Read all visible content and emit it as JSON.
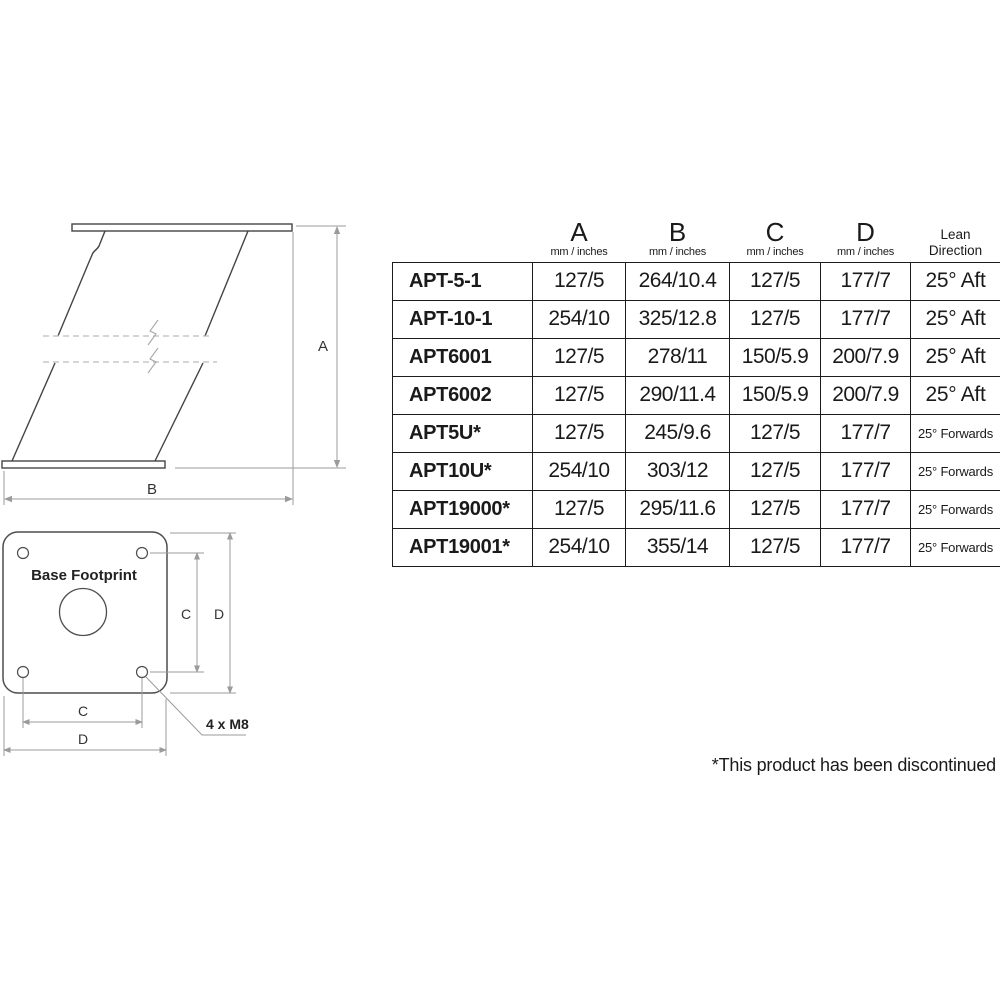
{
  "side_view": {
    "dim_a": "A",
    "dim_b": "B"
  },
  "footprint": {
    "title": "Base Footprint",
    "dim_c_vertical": "C",
    "dim_d_vertical": "D",
    "dim_c_horizontal": "C",
    "dim_d_horizontal": "D",
    "bolt_note": "4 x M8"
  },
  "spec_table": {
    "header": {
      "a": {
        "label": "A",
        "unit": "mm / inches"
      },
      "b": {
        "label": "B",
        "unit": "mm / inches"
      },
      "c": {
        "label": "C",
        "unit": "mm / inches"
      },
      "d": {
        "label": "D",
        "unit": "mm / inches"
      },
      "lean": {
        "line1": "Lean",
        "line2": "Direction"
      }
    },
    "rows": [
      {
        "model": "APT-5-1",
        "a": "127/5",
        "b": "264/10.4",
        "c": "127/5",
        "d": "177/7",
        "lean": "25° Aft"
      },
      {
        "model": "APT-10-1",
        "a": "254/10",
        "b": "325/12.8",
        "c": "127/5",
        "d": "177/7",
        "lean": "25° Aft"
      },
      {
        "model": "APT6001",
        "a": "127/5",
        "b": "278/11",
        "c": "150/5.9",
        "d": "200/7.9",
        "lean": "25° Aft"
      },
      {
        "model": "APT6002",
        "a": "127/5",
        "b": "290/11.4",
        "c": "150/5.9",
        "d": "200/7.9",
        "lean": "25° Aft"
      },
      {
        "model": "APT5U*",
        "a": "127/5",
        "b": "245/9.6",
        "c": "127/5",
        "d": "177/7",
        "lean": "25° Forwards"
      },
      {
        "model": "APT10U*",
        "a": "254/10",
        "b": "303/12",
        "c": "127/5",
        "d": "177/7",
        "lean": "25° Forwards"
      },
      {
        "model": "APT19000*",
        "a": "127/5",
        "b": "295/11.6",
        "c": "127/5",
        "d": "177/7",
        "lean": "25° Forwards"
      },
      {
        "model": "APT19001*",
        "a": "254/10",
        "b": "355/14",
        "c": "127/5",
        "d": "177/7",
        "lean": "25° Forwards"
      }
    ]
  },
  "footnote": "*This product has been discontinued",
  "colors": {
    "drawing_line": "#444444",
    "dimension_line": "#9b9b9b",
    "break_line": "#bcbcbc",
    "table_border": "#1c1c1c",
    "text": "#1a1a1a"
  }
}
